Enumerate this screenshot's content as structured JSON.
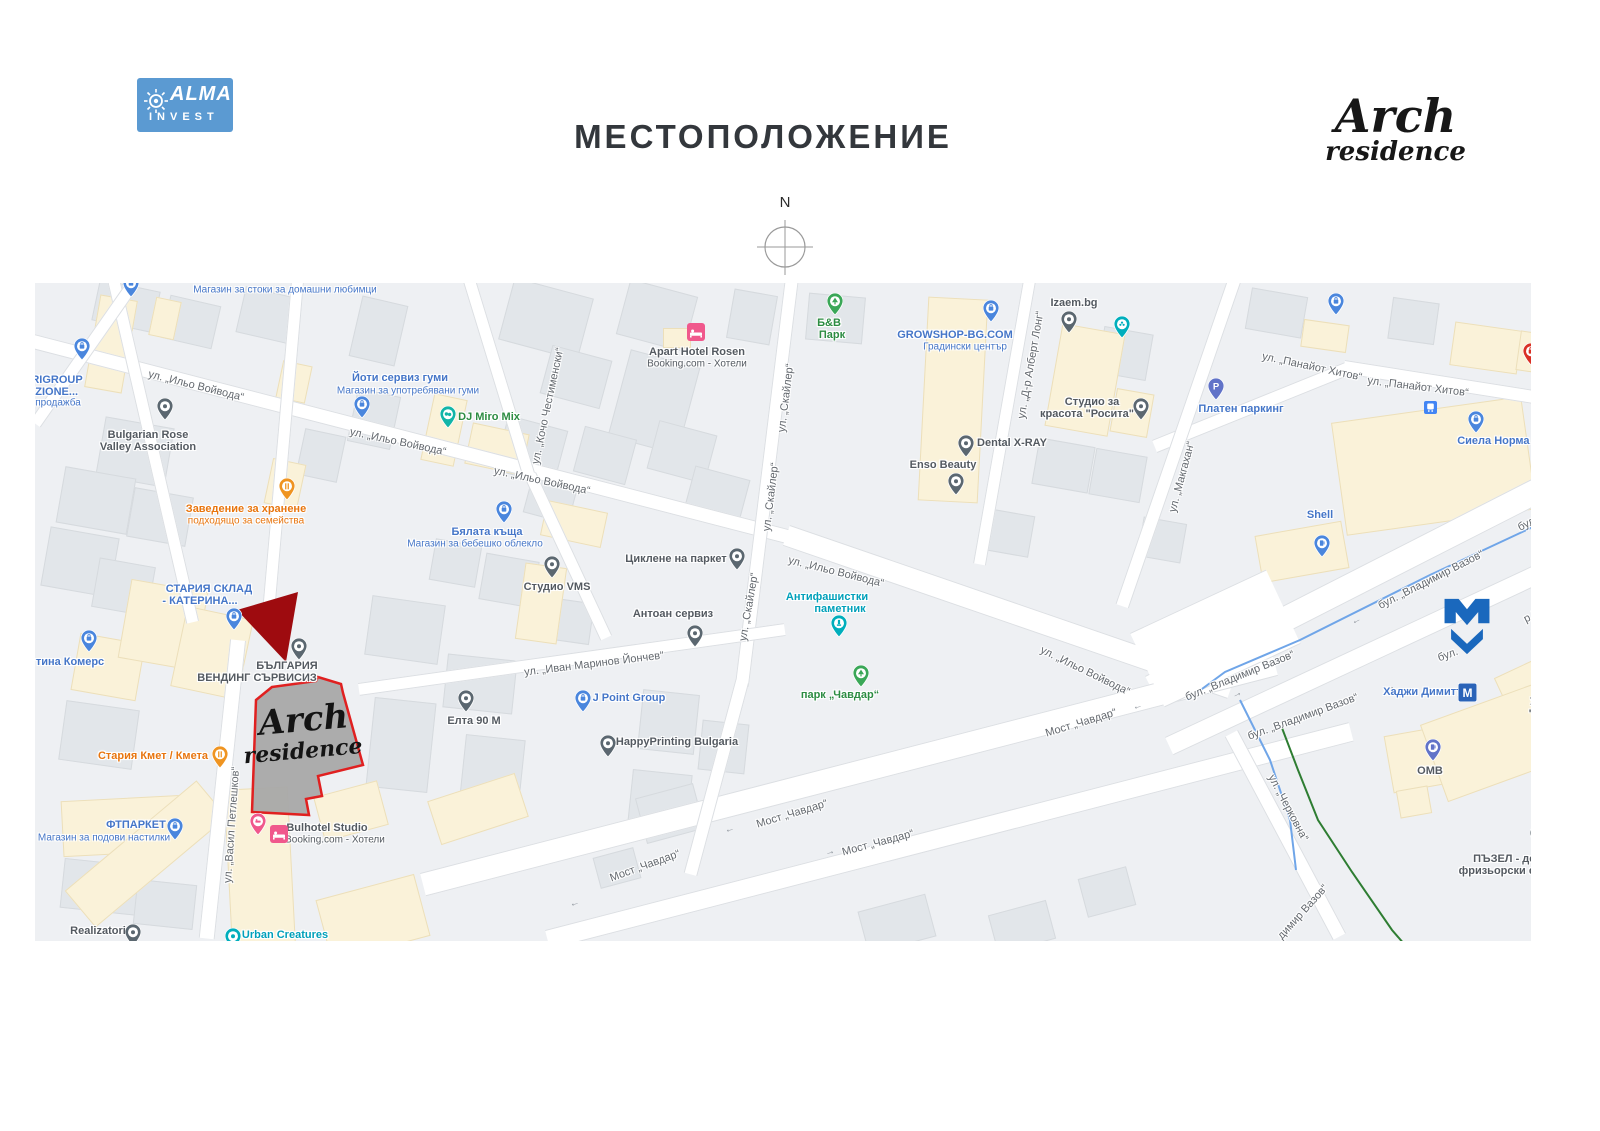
{
  "header": {
    "logo_line1": "ALMA",
    "logo_line2": "INVEST",
    "title": "МЕСТОПОЛОЖЕНИЕ",
    "brand_line1": "Arch",
    "brand_line2": "residence",
    "compass_label": "N"
  },
  "colors": {
    "accent_red": "#c31111",
    "site_fill": "#a8a8a8",
    "site_outline": "#e02020",
    "metro_blue": "#1a68bd",
    "logo_blue": "#5b9ad2"
  },
  "map": {
    "site": {
      "line1": "Arch",
      "line2": "residence"
    },
    "streets": [
      {
        "t": "ул. „Ильо Войвода“",
        "x": 161,
        "y": 103,
        "r": 14
      },
      {
        "t": "ул. „Ильо Войвода“",
        "x": 363,
        "y": 159,
        "r": 12
      },
      {
        "t": "ул. „Ильо Войвода“",
        "x": 507,
        "y": 198,
        "r": 12
      },
      {
        "t": "ул. „Ильо Войвода“",
        "x": 801,
        "y": 289,
        "r": 14
      },
      {
        "t": "ул. „Ильо Войвода“",
        "x": 1050,
        "y": 388,
        "r": 26
      },
      {
        "t": "ул. „Кочо Честименски“",
        "x": 513,
        "y": 123,
        "r": -78
      },
      {
        "t": "ул. „Скайлер“",
        "x": 751,
        "y": 115,
        "r": -83
      },
      {
        "t": "ул. „Скайлер“",
        "x": 736,
        "y": 214,
        "r": -83
      },
      {
        "t": "ул. „Скайлер“",
        "x": 714,
        "y": 324,
        "r": -80
      },
      {
        "t": "ул. „Иван Маринов Йончев“",
        "x": 559,
        "y": 381,
        "r": -7
      },
      {
        "t": "ул. „Д-р Алберт Лонг“",
        "x": 996,
        "y": 82,
        "r": -80
      },
      {
        "t": "ул. „Панайот Хитов“",
        "x": 1277,
        "y": 84,
        "r": 12
      },
      {
        "t": "ул. „Панайот Хитов“",
        "x": 1383,
        "y": 104,
        "r": 7
      },
      {
        "t": "ул. „Макгахан“",
        "x": 1147,
        "y": 194,
        "r": -75
      },
      {
        "t": "бул. „Владимир Вазов“",
        "x": 1396,
        "y": 297,
        "r": -27
      },
      {
        "t": "бул. „Владимир Вазов“",
        "x": 1205,
        "y": 393,
        "r": -22
      },
      {
        "t": "бул. „Владимир Вазов“",
        "x": 1268,
        "y": 434,
        "r": -20
      },
      {
        "t": "бул. „Вл",
        "x": 1502,
        "y": 236,
        "r": -27
      },
      {
        "t": "бул.",
        "x": 1413,
        "y": 372,
        "r": -20
      },
      {
        "t": "р Вазов",
        "x": 1507,
        "y": 328,
        "r": -27
      },
      {
        "t": "Мост „Чавдар“",
        "x": 1046,
        "y": 440,
        "r": -17
      },
      {
        "t": "Мост „Чавдар“",
        "x": 757,
        "y": 531,
        "r": -17
      },
      {
        "t": "Мост „Чавдар“",
        "x": 610,
        "y": 583,
        "r": -20
      },
      {
        "t": "Мост „Чавдар“",
        "x": 843,
        "y": 560,
        "r": -15
      },
      {
        "t": "ул. „Васил Петлешков“",
        "x": 197,
        "y": 542,
        "r": -86
      },
      {
        "t": "ул. „Черковна“",
        "x": 1253,
        "y": 525,
        "r": 62
      },
      {
        "t": "димир Вазов“",
        "x": 1268,
        "y": 629,
        "r": -48
      }
    ],
    "pois": [
      {
        "name": "rigroup",
        "pin": {
          "type": "bag",
          "color": "blue",
          "x": 47,
          "y": 77
        },
        "lines": [
          {
            "t": "RIGROUP",
            "x": 22,
            "y": 97,
            "c": "blue"
          },
          {
            "t": "EZIONE...",
            "x": 18,
            "y": 109,
            "c": "blue"
          },
          {
            "t": "продажба",
            "x": 23,
            "y": 120,
            "c": "blue",
            "s": 1
          }
        ]
      },
      {
        "name": "pet-shop-top",
        "pin": {
          "type": "bag",
          "color": "blue",
          "x": 96,
          "y": 14
        },
        "lines": [
          {
            "t": "Магазин за стоки за домашни любимци",
            "x": 250,
            "y": 7,
            "c": "blue",
            "s": 1
          }
        ]
      },
      {
        "name": "bulgarian-rose-valley",
        "pin": {
          "type": "dot",
          "color": "slate",
          "x": 130,
          "y": 137
        },
        "lines": [
          {
            "t": "Bulgarian Rose",
            "x": 113,
            "y": 152,
            "c": "dark"
          },
          {
            "t": "Valley Association",
            "x": 113,
            "y": 164,
            "c": "dark"
          }
        ]
      },
      {
        "name": "yoti-service",
        "pin": {
          "type": "bag",
          "color": "blue",
          "x": 327,
          "y": 135
        },
        "lines": [
          {
            "t": "Йоти сервиз гуми",
            "x": 365,
            "y": 95,
            "c": "blue"
          },
          {
            "t": "Магазин за употребявани гуми",
            "x": 373,
            "y": 108,
            "c": "blue",
            "s": 1
          }
        ]
      },
      {
        "name": "zavedenie-hranene",
        "pin": {
          "type": "fork",
          "color": "orange",
          "x": 252,
          "y": 217
        },
        "lines": [
          {
            "t": "Заведение за хранене",
            "x": 211,
            "y": 226,
            "c": "orange"
          },
          {
            "t": "подходящо за семейства",
            "x": 211,
            "y": 238,
            "c": "orange",
            "s": 1
          }
        ]
      },
      {
        "name": "dj-miro-mix",
        "pin": {
          "type": "masks",
          "color": "teal2",
          "x": 413,
          "y": 145
        },
        "lines": [
          {
            "t": "DJ Miro Mix",
            "x": 454,
            "y": 134,
            "c": "green"
          }
        ]
      },
      {
        "name": "bialata-kashta",
        "pin": {
          "type": "bag",
          "color": "blue",
          "x": 469,
          "y": 240
        },
        "lines": [
          {
            "t": "Бялата къща",
            "x": 452,
            "y": 249,
            "c": "blue"
          },
          {
            "t": "Магазин за бебешко облекло",
            "x": 440,
            "y": 261,
            "c": "blue",
            "s": 1
          }
        ]
      },
      {
        "name": "apart-hotel-rosen",
        "square": {
          "type": "bed",
          "x": 661,
          "y": 49
        },
        "lines": [
          {
            "t": "Apart Hotel Rosen",
            "x": 662,
            "y": 69,
            "c": "dark"
          },
          {
            "t": "Booking.com - Хотели",
            "x": 662,
            "y": 81,
            "c": "dark",
            "s": 1
          }
        ]
      },
      {
        "name": "studio-vms",
        "pin": {
          "type": "dot",
          "color": "slate",
          "x": 517,
          "y": 295
        },
        "lines": [
          {
            "t": "Студио VMS",
            "x": 522,
            "y": 304,
            "c": "dark"
          }
        ]
      },
      {
        "name": "tsiklene-parket",
        "pin": {
          "type": "dot",
          "color": "slate",
          "x": 702,
          "y": 287
        },
        "lines": [
          {
            "t": "Циклене на паркет",
            "x": 641,
            "y": 276,
            "c": "dark"
          }
        ]
      },
      {
        "name": "antoan-service",
        "pin": {
          "type": "dot",
          "color": "slate",
          "x": 660,
          "y": 364
        },
        "lines": [
          {
            "t": "Антоан сервиз",
            "x": 638,
            "y": 331,
            "c": "dark"
          }
        ]
      },
      {
        "name": "studio-rosita",
        "pin": {
          "type": "dot",
          "color": "slate",
          "x": 1106,
          "y": 137
        },
        "lines": [
          {
            "t": "Студио за",
            "x": 1057,
            "y": 119,
            "c": "dark"
          },
          {
            "t": "красота \"Росита\"",
            "x": 1052,
            "y": 131,
            "c": "dark"
          }
        ]
      },
      {
        "name": "dental-xray",
        "pin": {
          "type": "dot",
          "color": "slate",
          "x": 931,
          "y": 174
        },
        "lines": [
          {
            "t": "Dental X-RAY",
            "x": 977,
            "y": 160,
            "c": "dark"
          }
        ]
      },
      {
        "name": "enso-beauty",
        "pin": {
          "type": "dot",
          "color": "slate",
          "x": 921,
          "y": 212
        },
        "lines": [
          {
            "t": "Enso Beauty",
            "x": 908,
            "y": 182,
            "c": "dark"
          }
        ]
      },
      {
        "name": "bv-park",
        "pin": {
          "type": "tree",
          "color": "green",
          "x": 800,
          "y": 32
        },
        "lines": [
          {
            "t": "Б&В",
            "x": 794,
            "y": 40,
            "c": "green"
          },
          {
            "t": "Парк",
            "x": 797,
            "y": 52,
            "c": "green"
          }
        ]
      },
      {
        "name": "growshop",
        "pin": {
          "type": "bag",
          "color": "blue",
          "x": 956,
          "y": 39
        },
        "lines": [
          {
            "t": "GROWSHOP-BG.COM",
            "x": 920,
            "y": 52,
            "c": "blue"
          },
          {
            "t": "Градински център",
            "x": 930,
            "y": 64,
            "c": "blue",
            "s": 1
          }
        ]
      },
      {
        "name": "izaem",
        "pin": {
          "type": "dot",
          "color": "slate",
          "x": 1034,
          "y": 50
        },
        "lines": [
          {
            "t": "Izaem.bg",
            "x": 1039,
            "y": 20,
            "c": "dark"
          }
        ]
      },
      {
        "name": "spa-pin",
        "pin": {
          "type": "flower",
          "color": "teal",
          "x": 1087,
          "y": 55
        },
        "lines": []
      },
      {
        "name": "platen-parking",
        "pin": {
          "type": "p",
          "color": "indigo",
          "x": 1181,
          "y": 117
        },
        "lines": [
          {
            "t": "Платен паркинг",
            "x": 1206,
            "y": 126,
            "c": "blue"
          }
        ]
      },
      {
        "name": "siela-norma",
        "pin": {
          "type": "bag",
          "color": "blue",
          "x": 1441,
          "y": 150
        },
        "lines": [
          {
            "t": "Сиела Норма АД",
            "x": 1468,
            "y": 158,
            "c": "blue"
          }
        ]
      },
      {
        "name": "cp-store",
        "pin": {
          "type": "bag",
          "color": "red",
          "x": 1496,
          "y": 82
        },
        "lines": [
          {
            "t": "СР",
            "x": 1516,
            "y": 70,
            "c": "red"
          }
        ]
      },
      {
        "name": "top-right-shop-pin",
        "pin": {
          "type": "bag",
          "color": "blue",
          "x": 1301,
          "y": 32
        },
        "lines": []
      },
      {
        "name": "shell",
        "pin": {
          "type": "fuel",
          "color": "blue",
          "x": 1287,
          "y": 274
        },
        "lines": [
          {
            "t": "Shell",
            "x": 1285,
            "y": 232,
            "c": "blue"
          }
        ]
      },
      {
        "name": "transit-stop",
        "square": {
          "type": "transit",
          "x": 1398,
          "y": 127
        },
        "lines": []
      },
      {
        "name": "hadzhi-dimitar-metro",
        "square": {
          "type": "m",
          "x": 1432,
          "y": 409
        },
        "lines": [
          {
            "t": "Хаджи Димитър",
            "x": 1392,
            "y": 409,
            "c": "blue"
          }
        ]
      },
      {
        "name": "ucheben",
        "pin": {
          "type": "dot",
          "color": "slate",
          "x": 1513,
          "y": 408
        },
        "lines": [
          {
            "t": "Учеб",
            "x": 1508,
            "y": 419,
            "c": "dark"
          },
          {
            "t": "'Сто",
            "x": 1505,
            "y": 431,
            "c": "dark"
          }
        ]
      },
      {
        "name": "omv",
        "pin": {
          "type": "fuel",
          "color": "indigo",
          "x": 1398,
          "y": 478
        },
        "lines": [
          {
            "t": "OMB",
            "x": 1395,
            "y": 488,
            "c": "dark"
          }
        ]
      },
      {
        "name": "puzel-salon",
        "pin": {
          "type": "dot",
          "color": "slate",
          "x": 1503,
          "y": 564
        },
        "lines": [
          {
            "t": "ПЪЗЕЛ - детски",
            "x": 1481,
            "y": 576,
            "c": "dark"
          },
          {
            "t": "фризьорски салон",
            "x": 1475,
            "y": 588,
            "c": "dark"
          }
        ]
      },
      {
        "name": "ftparket",
        "pin": {
          "type": "bag",
          "color": "blue",
          "x": 140,
          "y": 557
        },
        "lines": [
          {
            "t": "ФТПАРКЕТ",
            "x": 101,
            "y": 542,
            "c": "blue"
          },
          {
            "t": "Магазин за подови настилки",
            "x": 69,
            "y": 555,
            "c": "blue",
            "s": 1
          }
        ]
      },
      {
        "name": "realizatori",
        "pin": {
          "type": "dot",
          "color": "slate",
          "x": 98,
          "y": 663
        },
        "lines": [
          {
            "t": "Realizatori",
            "x": 63,
            "y": 648,
            "c": "dark"
          }
        ]
      },
      {
        "name": "urban-creatures",
        "pin": {
          "type": "dot",
          "color": "teal",
          "x": 198,
          "y": 667
        },
        "lines": [
          {
            "t": "Urban Creatures",
            "x": 250,
            "y": 652,
            "c": "teal"
          },
          {
            "t": "\"Ninetees\"",
            "x": 250,
            "y": 664,
            "c": "teal"
          }
        ]
      },
      {
        "name": "bulhotel-studio",
        "pin": {
          "type": "bed",
          "color": "pink",
          "x": 223,
          "y": 552
        },
        "square": {
          "type": "bed",
          "x": 244,
          "y": 551
        },
        "lines": [
          {
            "t": "Bulhotel Studio",
            "x": 292,
            "y": 545,
            "c": "dark"
          },
          {
            "t": "Booking.com - Хотели",
            "x": 300,
            "y": 557,
            "c": "dark",
            "s": 1
          }
        ]
      },
      {
        "name": "bg-vending",
        "pin": {
          "type": "dot",
          "color": "slate",
          "x": 264,
          "y": 377
        },
        "lines": [
          {
            "t": "БЪЛГАРИЯ",
            "x": 252,
            "y": 383,
            "c": "dark"
          },
          {
            "t": "ВЕНДИНГ СЪРВИСИЗ",
            "x": 222,
            "y": 395,
            "c": "dark"
          }
        ]
      },
      {
        "name": "stariya-sklad",
        "pin": {
          "type": "bag",
          "color": "blue",
          "x": 199,
          "y": 347
        },
        "lines": [
          {
            "t": "СТАРИЯ СКЛАД",
            "x": 174,
            "y": 306,
            "c": "blue"
          },
          {
            "t": "- КАТЕРИНА...",
            "x": 165,
            "y": 318,
            "c": "blue"
          }
        ]
      },
      {
        "name": "tina-komers",
        "pin": {
          "type": "bag",
          "color": "blue",
          "x": 54,
          "y": 369
        },
        "lines": [
          {
            "t": "тина Комерс",
            "x": 35,
            "y": 379,
            "c": "blue"
          }
        ]
      },
      {
        "name": "stariya-kmet",
        "pin": {
          "type": "fork",
          "color": "orange",
          "x": 185,
          "y": 485
        },
        "lines": [
          {
            "t": "Стария Кмет / Кмета",
            "x": 118,
            "y": 473,
            "c": "orange"
          }
        ]
      },
      {
        "name": "elta-90m",
        "pin": {
          "type": "dot",
          "color": "slate",
          "x": 431,
          "y": 429
        },
        "lines": [
          {
            "t": "Елта 90 М",
            "x": 439,
            "y": 438,
            "c": "dark"
          }
        ]
      },
      {
        "name": "j-point-group",
        "pin": {
          "type": "bag",
          "color": "blue",
          "x": 548,
          "y": 429
        },
        "lines": [
          {
            "t": "J Point Group",
            "x": 594,
            "y": 415,
            "c": "blue"
          }
        ]
      },
      {
        "name": "happyprinting",
        "pin": {
          "type": "dot",
          "color": "slate",
          "x": 573,
          "y": 474
        },
        "lines": [
          {
            "t": "HappyPrinting Bulgaria",
            "x": 642,
            "y": 459,
            "c": "dark"
          }
        ]
      },
      {
        "name": "antifa-monument",
        "pin": {
          "type": "monument",
          "color": "teal",
          "x": 804,
          "y": 354
        },
        "lines": [
          {
            "t": "Антифашистки",
            "x": 792,
            "y": 314,
            "c": "teal"
          },
          {
            "t": "паметник",
            "x": 805,
            "y": 326,
            "c": "teal"
          }
        ]
      },
      {
        "name": "park-chavdar",
        "pin": {
          "type": "tree",
          "color": "green",
          "x": 826,
          "y": 404
        },
        "lines": [
          {
            "t": "парк „Чавдар“",
            "x": 805,
            "y": 412,
            "c": "green"
          }
        ]
      }
    ]
  }
}
